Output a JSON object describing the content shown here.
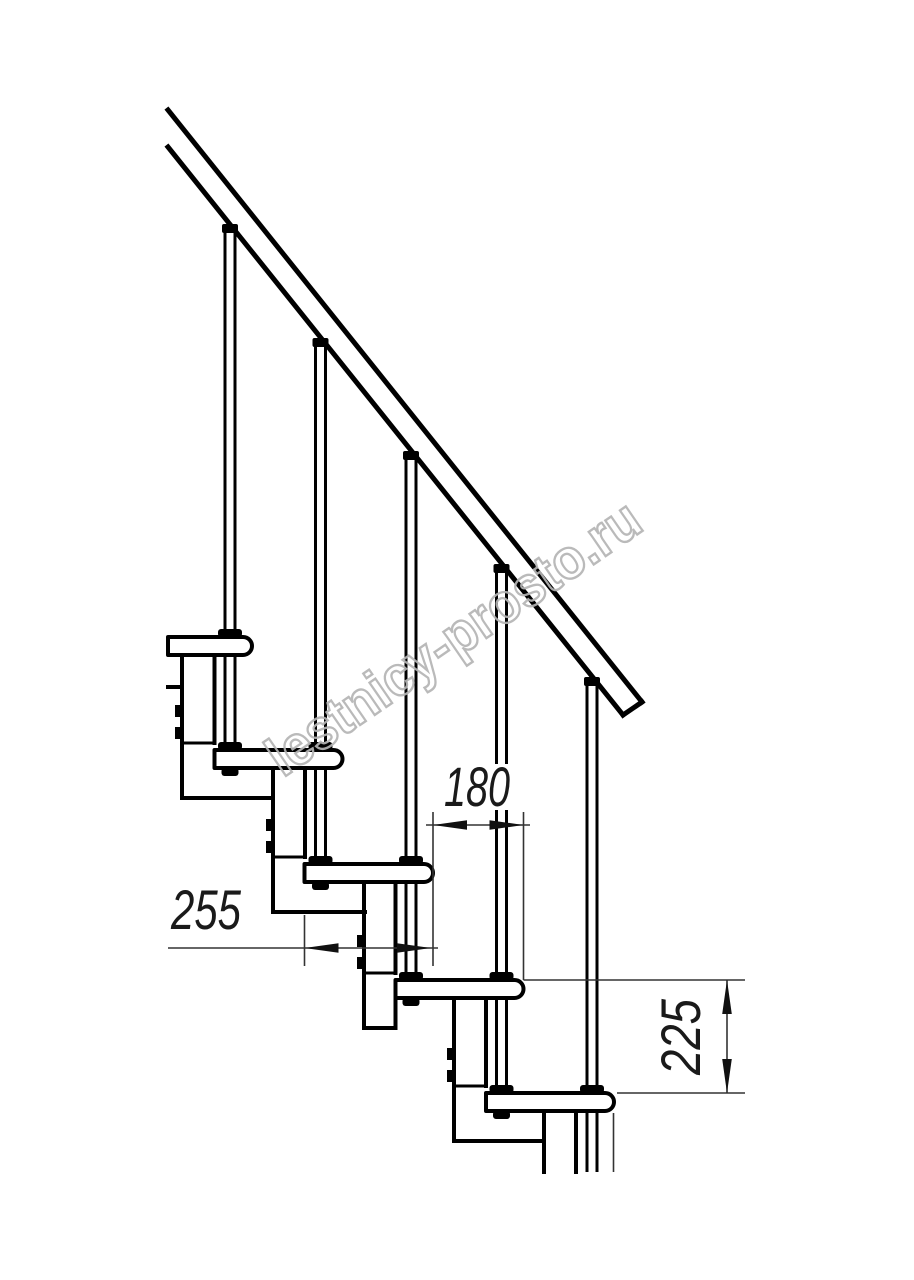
{
  "page": {
    "background": "#ffffff",
    "width": 914,
    "height": 1280
  },
  "drawing": {
    "subject": "modular staircase side view",
    "line_color": "#000000",
    "treads_visible": 5,
    "balusters_visible": 5,
    "has_handrail": true
  },
  "dimensions": {
    "step_run": "180",
    "tread_depth": "255",
    "step_rise": "225"
  },
  "watermark": {
    "text": "lestnicy-prosto.ru",
    "color": "#b5b5b5"
  }
}
